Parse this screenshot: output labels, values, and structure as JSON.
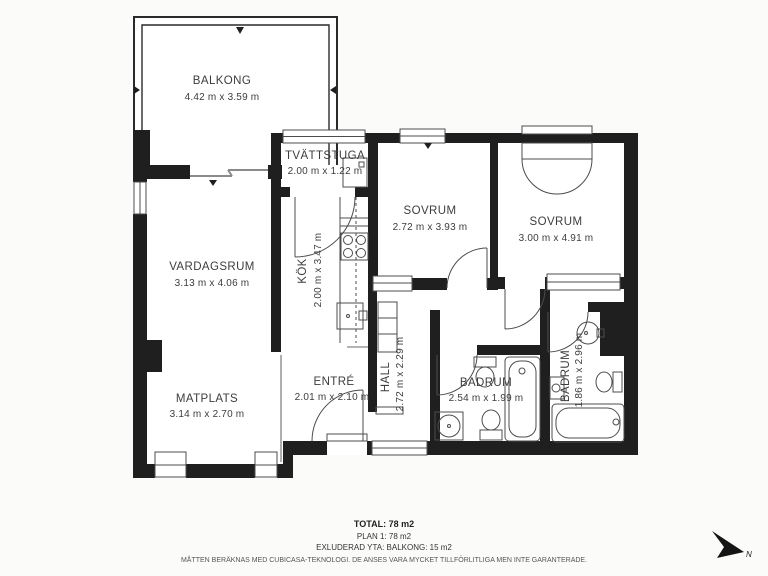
{
  "rooms": [
    {
      "id": "balkong",
      "name": "BALKONG",
      "dims": "4.42 m x 3.59 m",
      "orientation": "horizontal"
    },
    {
      "id": "tvattstuga",
      "name": "TVÄTTSTUGA",
      "dims": "2.00 m x 1.22 m",
      "orientation": "horizontal"
    },
    {
      "id": "sovrum-1",
      "name": "SOVRUM",
      "dims": "2.72 m x 3.93 m",
      "orientation": "horizontal"
    },
    {
      "id": "sovrum-2",
      "name": "SOVRUM",
      "dims": "3.00 m x 4.91 m",
      "orientation": "horizontal"
    },
    {
      "id": "vardagsrum",
      "name": "VARDAGSRUM",
      "dims": "3.13 m x 4.06 m",
      "orientation": "horizontal"
    },
    {
      "id": "kok",
      "name": "KÖK",
      "dims": "2.00 m x 3.47 m",
      "orientation": "vertical"
    },
    {
      "id": "matplats",
      "name": "MATPLATS",
      "dims": "3.14 m x 2.70 m",
      "orientation": "horizontal"
    },
    {
      "id": "entre",
      "name": "ENTRÉ",
      "dims": "2.01 m x 2.10 m",
      "orientation": "horizontal"
    },
    {
      "id": "hall",
      "name": "HALL",
      "dims": "2.72 m x 2.29 m",
      "orientation": "vertical"
    },
    {
      "id": "badrum-1",
      "name": "BADRUM",
      "dims": "2.54 m x 1.99 m",
      "orientation": "horizontal"
    },
    {
      "id": "badrum-2",
      "name": "BADRUM",
      "dims": "1.86 m x 2.96 m",
      "orientation": "vertical"
    }
  ],
  "summary": {
    "total": "TOTAL: 78 m2",
    "plan": "PLAN 1: 78 m2",
    "excluded": "EXLUDERAD YTA: BALKONG: 15 m2"
  },
  "disclaimer": "MÅTTEN BERÄKNAS MED CUBICASA-TEKNOLOGI. DE ANSES VARA MYCKET TILLFÖRLITLIGA MEN INTE GARANTERADE.",
  "compass": {
    "label": "N"
  },
  "colors": {
    "wall": "#1f1f1f",
    "floor": "#ffffff",
    "background": "#fbfbfa",
    "fixture_line": "#4c4c4c",
    "text": "#3d3d3d"
  }
}
